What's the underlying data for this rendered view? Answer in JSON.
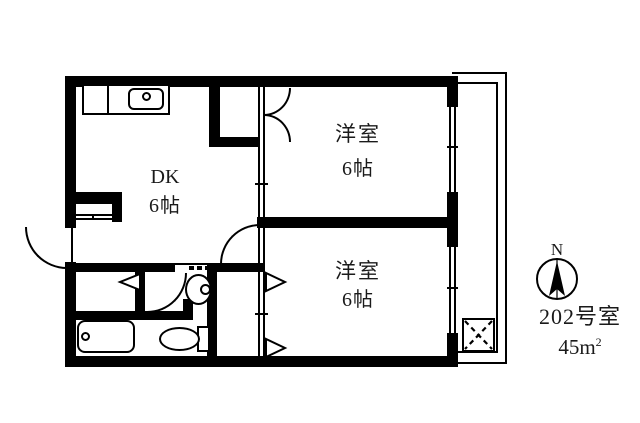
{
  "rooms": {
    "dk": {
      "name": "DK",
      "size": "6帖"
    },
    "western1": {
      "name": "洋室",
      "size": "6帖"
    },
    "western2": {
      "name": "洋室",
      "size": "6帖"
    }
  },
  "compass": {
    "north": "N"
  },
  "unit": {
    "number": "202号室",
    "area_value": "45",
    "area_unit": "m",
    "area_exp": "2"
  },
  "colors": {
    "line": "#000000",
    "background": "#ffffff"
  }
}
